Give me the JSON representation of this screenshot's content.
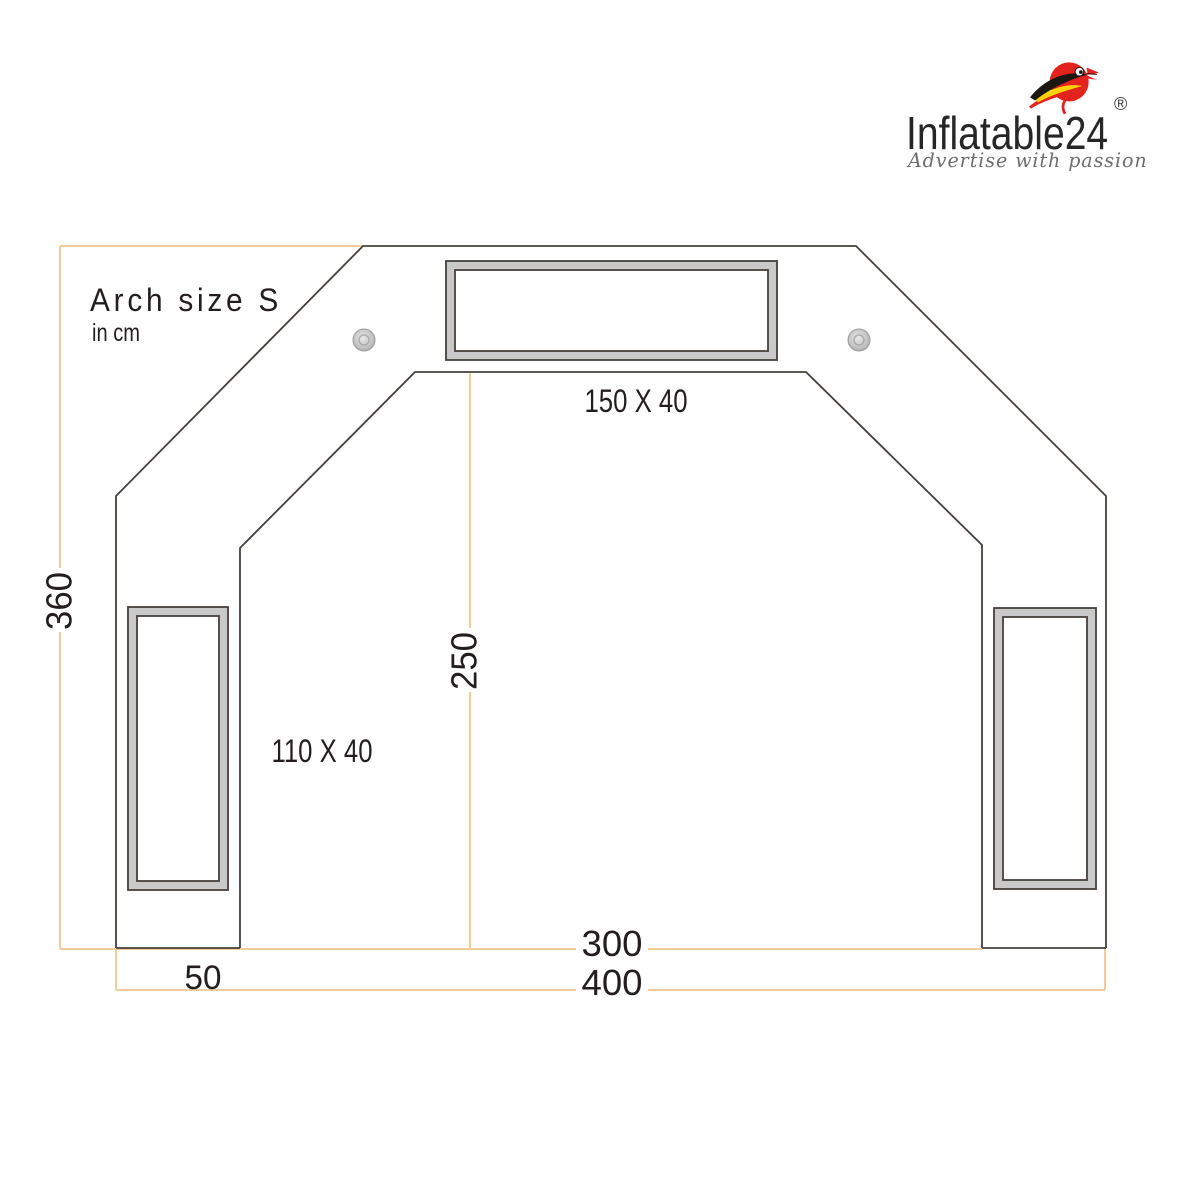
{
  "logo": {
    "brand": "Inflatable24",
    "registered_mark": "®",
    "tagline": "Advertise with passion",
    "colors": {
      "bird_red": "#e3231e",
      "wing_black": "#1c1713",
      "wing_yellow": "#ffd200",
      "tagline_gray": "#6d6d6d"
    }
  },
  "diagram": {
    "title": "Arch size S",
    "unit_note": "in cm",
    "dimensions": {
      "top_banner": "150 X 40",
      "side_banner": "110 X 40",
      "inner_height": "250",
      "total_height": "360",
      "inner_width": "300",
      "total_width": "400",
      "leg_width": "50"
    },
    "colors": {
      "outline": "#45403d",
      "dimension_line": "#f2cd9b",
      "banner_frame_gray": "#c9c9c9",
      "text": "#221e1e"
    }
  }
}
